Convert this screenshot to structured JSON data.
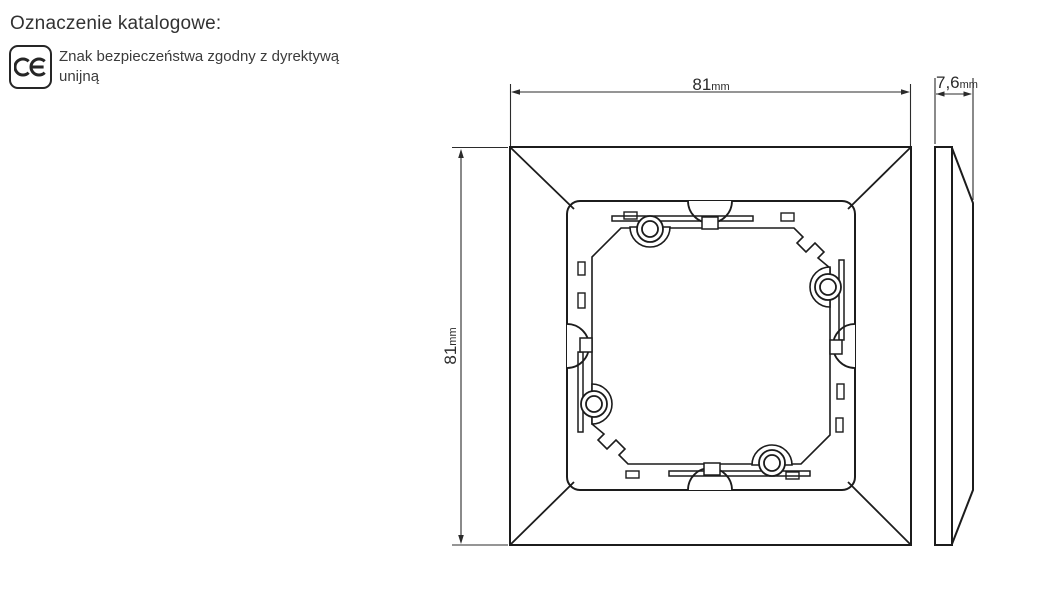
{
  "header": {
    "title": "Oznaczenie katalogowe:"
  },
  "certification": {
    "mark_label": "CE",
    "description_line1": "Znak bezpieczeństwa zgodny z dyrektywą",
    "description_line2": "unijną"
  },
  "drawing": {
    "front_view": {
      "width": {
        "value": "81",
        "unit": "mm"
      },
      "height": {
        "value": "81",
        "unit": "mm"
      }
    },
    "side_view": {
      "depth": {
        "value": "7,6",
        "unit": "mm"
      }
    }
  },
  "colors": {
    "line": "#1c1c1c",
    "text": "#333333",
    "background": "#ffffff"
  }
}
